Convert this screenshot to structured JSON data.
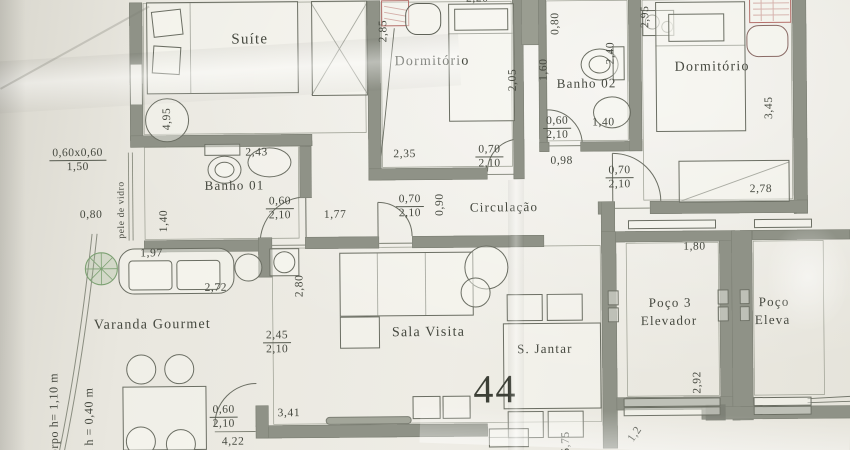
{
  "unit": {
    "number": "44"
  },
  "rooms": {
    "suite": "Suíte",
    "dormitorio1": "Dormitório",
    "banho01": "Banho 01",
    "banho02": "Banho 02",
    "dormitorio2": "Dormitório",
    "circulacao": "Circulação",
    "varanda": "Varanda Gourmet",
    "sala": "Sala Visita",
    "sjantar": "S. Jantar",
    "poco3_l1": "Poço 3",
    "poco3_l2": "Elevador",
    "pocoe_l1": "Poço",
    "pocoe_l2": "Eleva"
  },
  "annotations": {
    "pele_de_vidro": "pele de vidro",
    "guarda_corpo": "corpo h= 1,10 m",
    "mureta": "eta h = 0,40 m"
  },
  "dims": {
    "window_spec": "0,60x0,60",
    "window_sill": "1,50",
    "varanda_left": "0,80",
    "suite_depth": "4,95",
    "dorm1_left": "2,85",
    "dorm1_top": "2,20",
    "dorm1_width": "2,35",
    "dorm1_depth": "2,05",
    "door_dorm1_w": "0,70",
    "door_dorm1_h": "2,10",
    "circ_width": "0,90",
    "door_circ_w": "0,70",
    "door_circ_h": "2,10",
    "circ_len": "1,77",
    "banho1_len": "2,43",
    "banho1_width": "1,40",
    "door_banho1_w": "0,60",
    "door_banho1_h": "2,10",
    "banho2_top": "0,80",
    "dorm2_left_top": "2,95",
    "banho2_width": "1,60",
    "banho2_len": "2,40",
    "banho2_basin": "1,40",
    "door_banho2_w": "0,60",
    "door_banho2_h": "2,10",
    "hall_len": "0,98",
    "door_dorm2_w": "0,70",
    "door_dorm2_h": "2,10",
    "dorm2_depth": "3,45",
    "dorm2_wardrobe": "2,78",
    "varanda_sofa": "1,97",
    "varanda_width": "2,72",
    "sala_left": "2,80",
    "sala_opening_w": "2,45",
    "sala_opening_h": "2,10",
    "sala_width": "3,41",
    "door_varanda_w": "0,60",
    "door_varanda_h": "2,10",
    "varanda_len": "4,22",
    "poco3_width": "1,80",
    "poco3_depth": "2,92",
    "jantar_depth": "5,75",
    "bottom_partial": "1,2"
  },
  "colors": {
    "paper": "#e9e7df",
    "wall": "#8f9287",
    "line": "#6b6e63",
    "text": "#45483f",
    "red_furniture": "#b5706b",
    "tree_green": "#7da173"
  }
}
